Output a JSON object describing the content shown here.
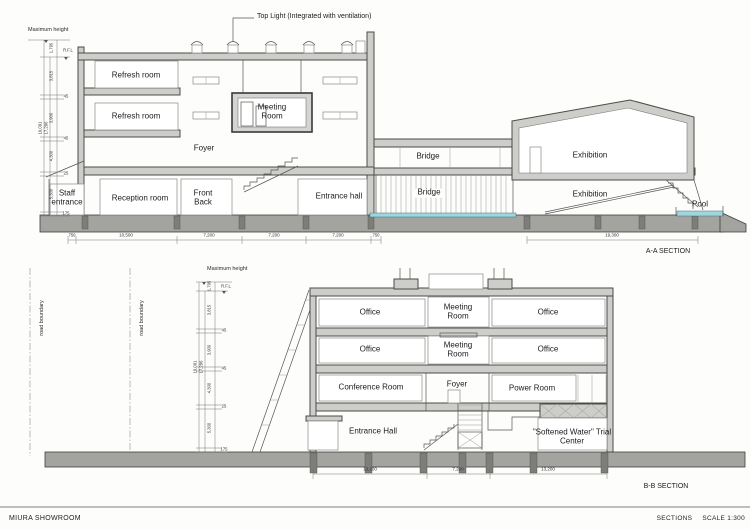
{
  "sheet": {
    "project": "MIURA SHOWROOM",
    "sheet_title": "SECTIONS",
    "scale": "SCALE 1:300"
  },
  "annotation": {
    "top_light": "Top Light (Integrated with ventilation)"
  },
  "colors": {
    "wall_gray": "#cdcdc9",
    "ground_gray": "#a3a3a0",
    "water_blue": "#9fd6dd",
    "line": "#4c4c4a"
  },
  "section_a": {
    "name": "A-A SECTION",
    "max_height": "Maximum height",
    "rfl": "R.F.L",
    "rooms": {
      "refresh_1": "Refresh room",
      "refresh_2": "Refresh room",
      "meeting": "Meeting Room",
      "foyer": "Foyer",
      "staff_entrance": "Staff entrance",
      "reception": "Reception room",
      "front": "Front",
      "back": "Back",
      "entrance_hall": "Entrance hall",
      "bridge_upper": "Bridge",
      "bridge_lower": "Bridge",
      "exhibition_upper": "Exhibition",
      "exhibition_lower": "Exhibition",
      "pool": "Pool"
    },
    "dims_left": {
      "segments": [
        "1,795",
        "3,815",
        "45",
        "3,900",
        "45",
        "4,300",
        "25",
        "5,300",
        "175"
      ],
      "overall": [
        "19,091",
        "17,296"
      ]
    },
    "dims_bottom": [
      "750",
      "10,500",
      "7,200",
      "7,200",
      "7,200",
      "750"
    ],
    "dim_exhibition": "19,300"
  },
  "section_b": {
    "name": "B-B SECTION",
    "max_height": "Maximum height",
    "rfl": "R.F.L",
    "road_boundary_left": "road boundary",
    "road_boundary_right": "road boundary",
    "rooms": {
      "office_3f_left": "Office",
      "meeting_3f": "Meeting Room",
      "office_3f_right": "Office",
      "office_2f_left": "Office",
      "meeting_2f": "Meeting Room",
      "office_2f_right": "Office",
      "conference": "Conference Room",
      "foyer": "Foyer",
      "power": "Power Room",
      "entrance_hall": "Entrance Hall",
      "softened_water": "\"Softened Water\" Trial Center"
    },
    "dims_left": {
      "segments": [
        "1,795",
        "3,815",
        "45",
        "3,900",
        "45",
        "4,300",
        "25",
        "5,300",
        "175"
      ],
      "overall": [
        "19,091",
        "17,296"
      ]
    },
    "dims_bottom": [
      "13,200",
      "7,200",
      "13,200"
    ]
  }
}
